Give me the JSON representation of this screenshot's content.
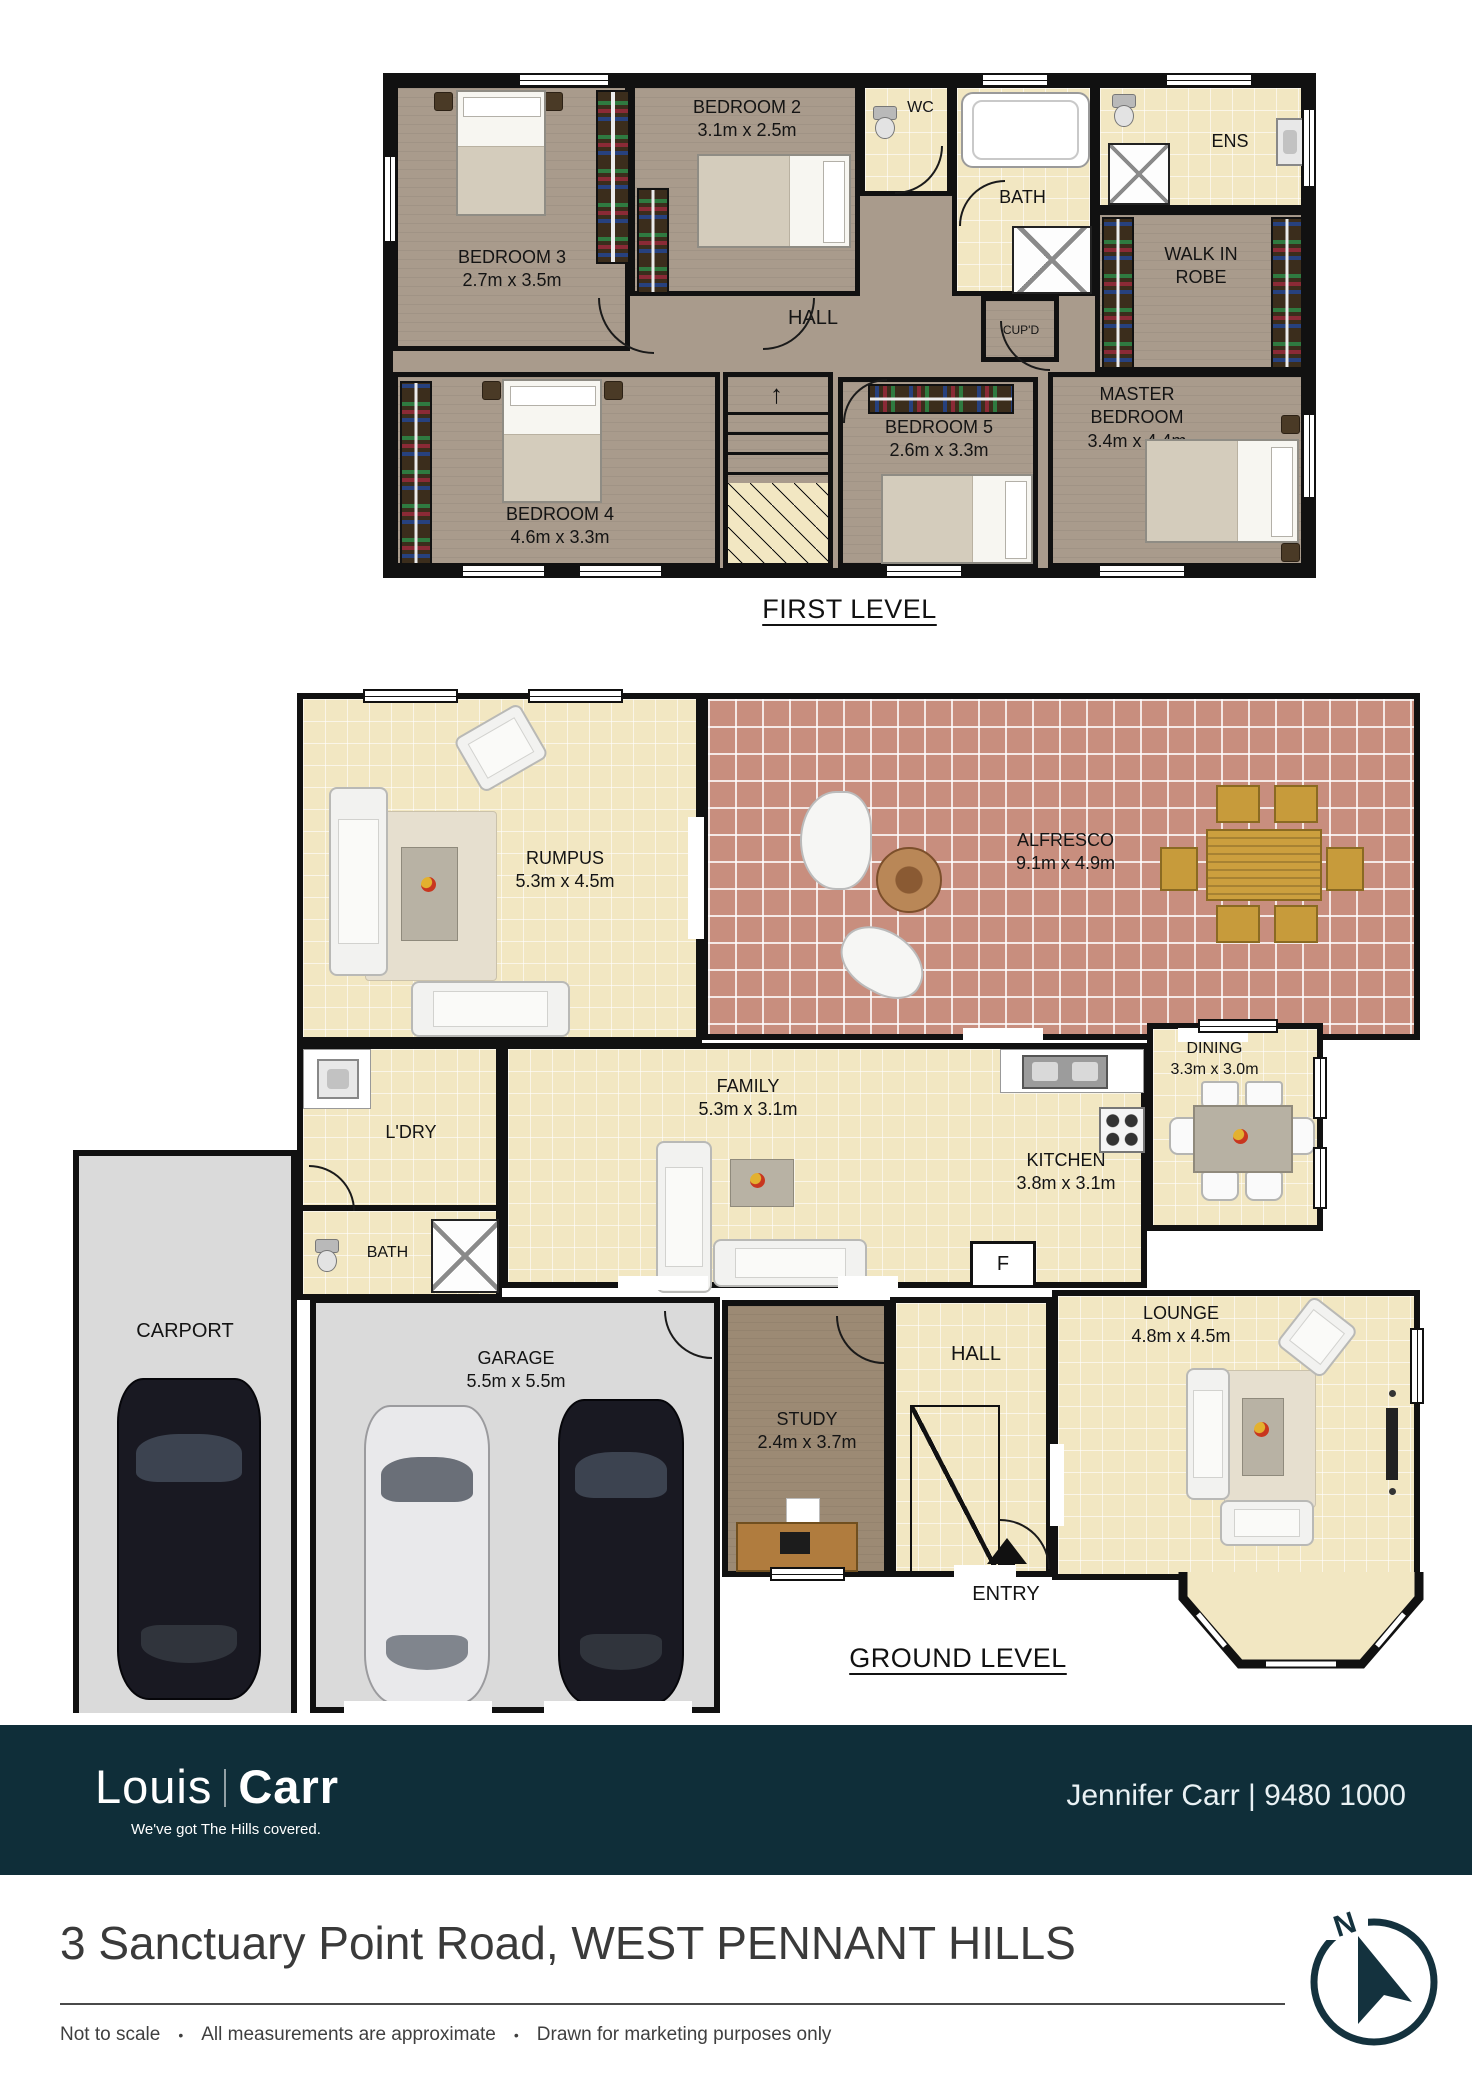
{
  "first_level": {
    "caption": "FIRST LEVEL",
    "rooms": [
      {
        "name": "BEDROOM 3",
        "dims": "2.7m x 3.5m"
      },
      {
        "name": "BEDROOM 2",
        "dims": "3.1m x 2.5m"
      },
      {
        "name": "WC"
      },
      {
        "name": "BATH"
      },
      {
        "name": "ENS"
      },
      {
        "name": "WALK IN ROBE"
      },
      {
        "name": "CUP'D"
      },
      {
        "name": "HALL"
      },
      {
        "name": "MASTER BEDROOM",
        "dims": "3.4m x 4.4m"
      },
      {
        "name": "BEDROOM 5",
        "dims": "2.6m x 3.3m"
      },
      {
        "name": "BEDROOM 4",
        "dims": "4.6m x 3.3m"
      }
    ]
  },
  "ground_level": {
    "caption": "GROUND LEVEL",
    "entry_label": "ENTRY",
    "fridge_label": "F",
    "rooms": [
      {
        "name": "RUMPUS",
        "dims": "5.3m x 4.5m"
      },
      {
        "name": "ALFRESCO",
        "dims": "9.1m x 4.9m"
      },
      {
        "name": "L'DRY"
      },
      {
        "name": "FAMILY",
        "dims": "5.3m x 3.1m"
      },
      {
        "name": "KITCHEN",
        "dims": "3.8m x 3.1m"
      },
      {
        "name": "DINING",
        "dims": "3.3m x 3.0m"
      },
      {
        "name": "BATH"
      },
      {
        "name": "CARPORT"
      },
      {
        "name": "GARAGE",
        "dims": "5.5m x 5.5m"
      },
      {
        "name": "STUDY",
        "dims": "2.4m x 3.7m"
      },
      {
        "name": "HALL"
      },
      {
        "name": "LOUNGE",
        "dims": "4.8m x 4.5m"
      }
    ]
  },
  "footer": {
    "brand_first": "Louis",
    "brand_second": "Carr",
    "tagline": "We've got The Hills covered.",
    "agent": "Jennifer Carr | 9480 1000"
  },
  "address": "3 Sanctuary Point Road, WEST PENNANT HILLS",
  "disclaimer": {
    "items": [
      "Not to scale",
      "All measurements are approximate",
      "Drawn for marketing purposes only"
    ]
  },
  "compass": {
    "north_label": "N"
  },
  "colors": {
    "brand_bg": "#0f2e39",
    "wall": "#111111",
    "floor_taupe": "#a99b8c",
    "floor_tile": "#f2e7c2",
    "floor_brick": "#c88e7e",
    "floor_concrete": "#dadada",
    "floor_study": "#9c8a74"
  }
}
